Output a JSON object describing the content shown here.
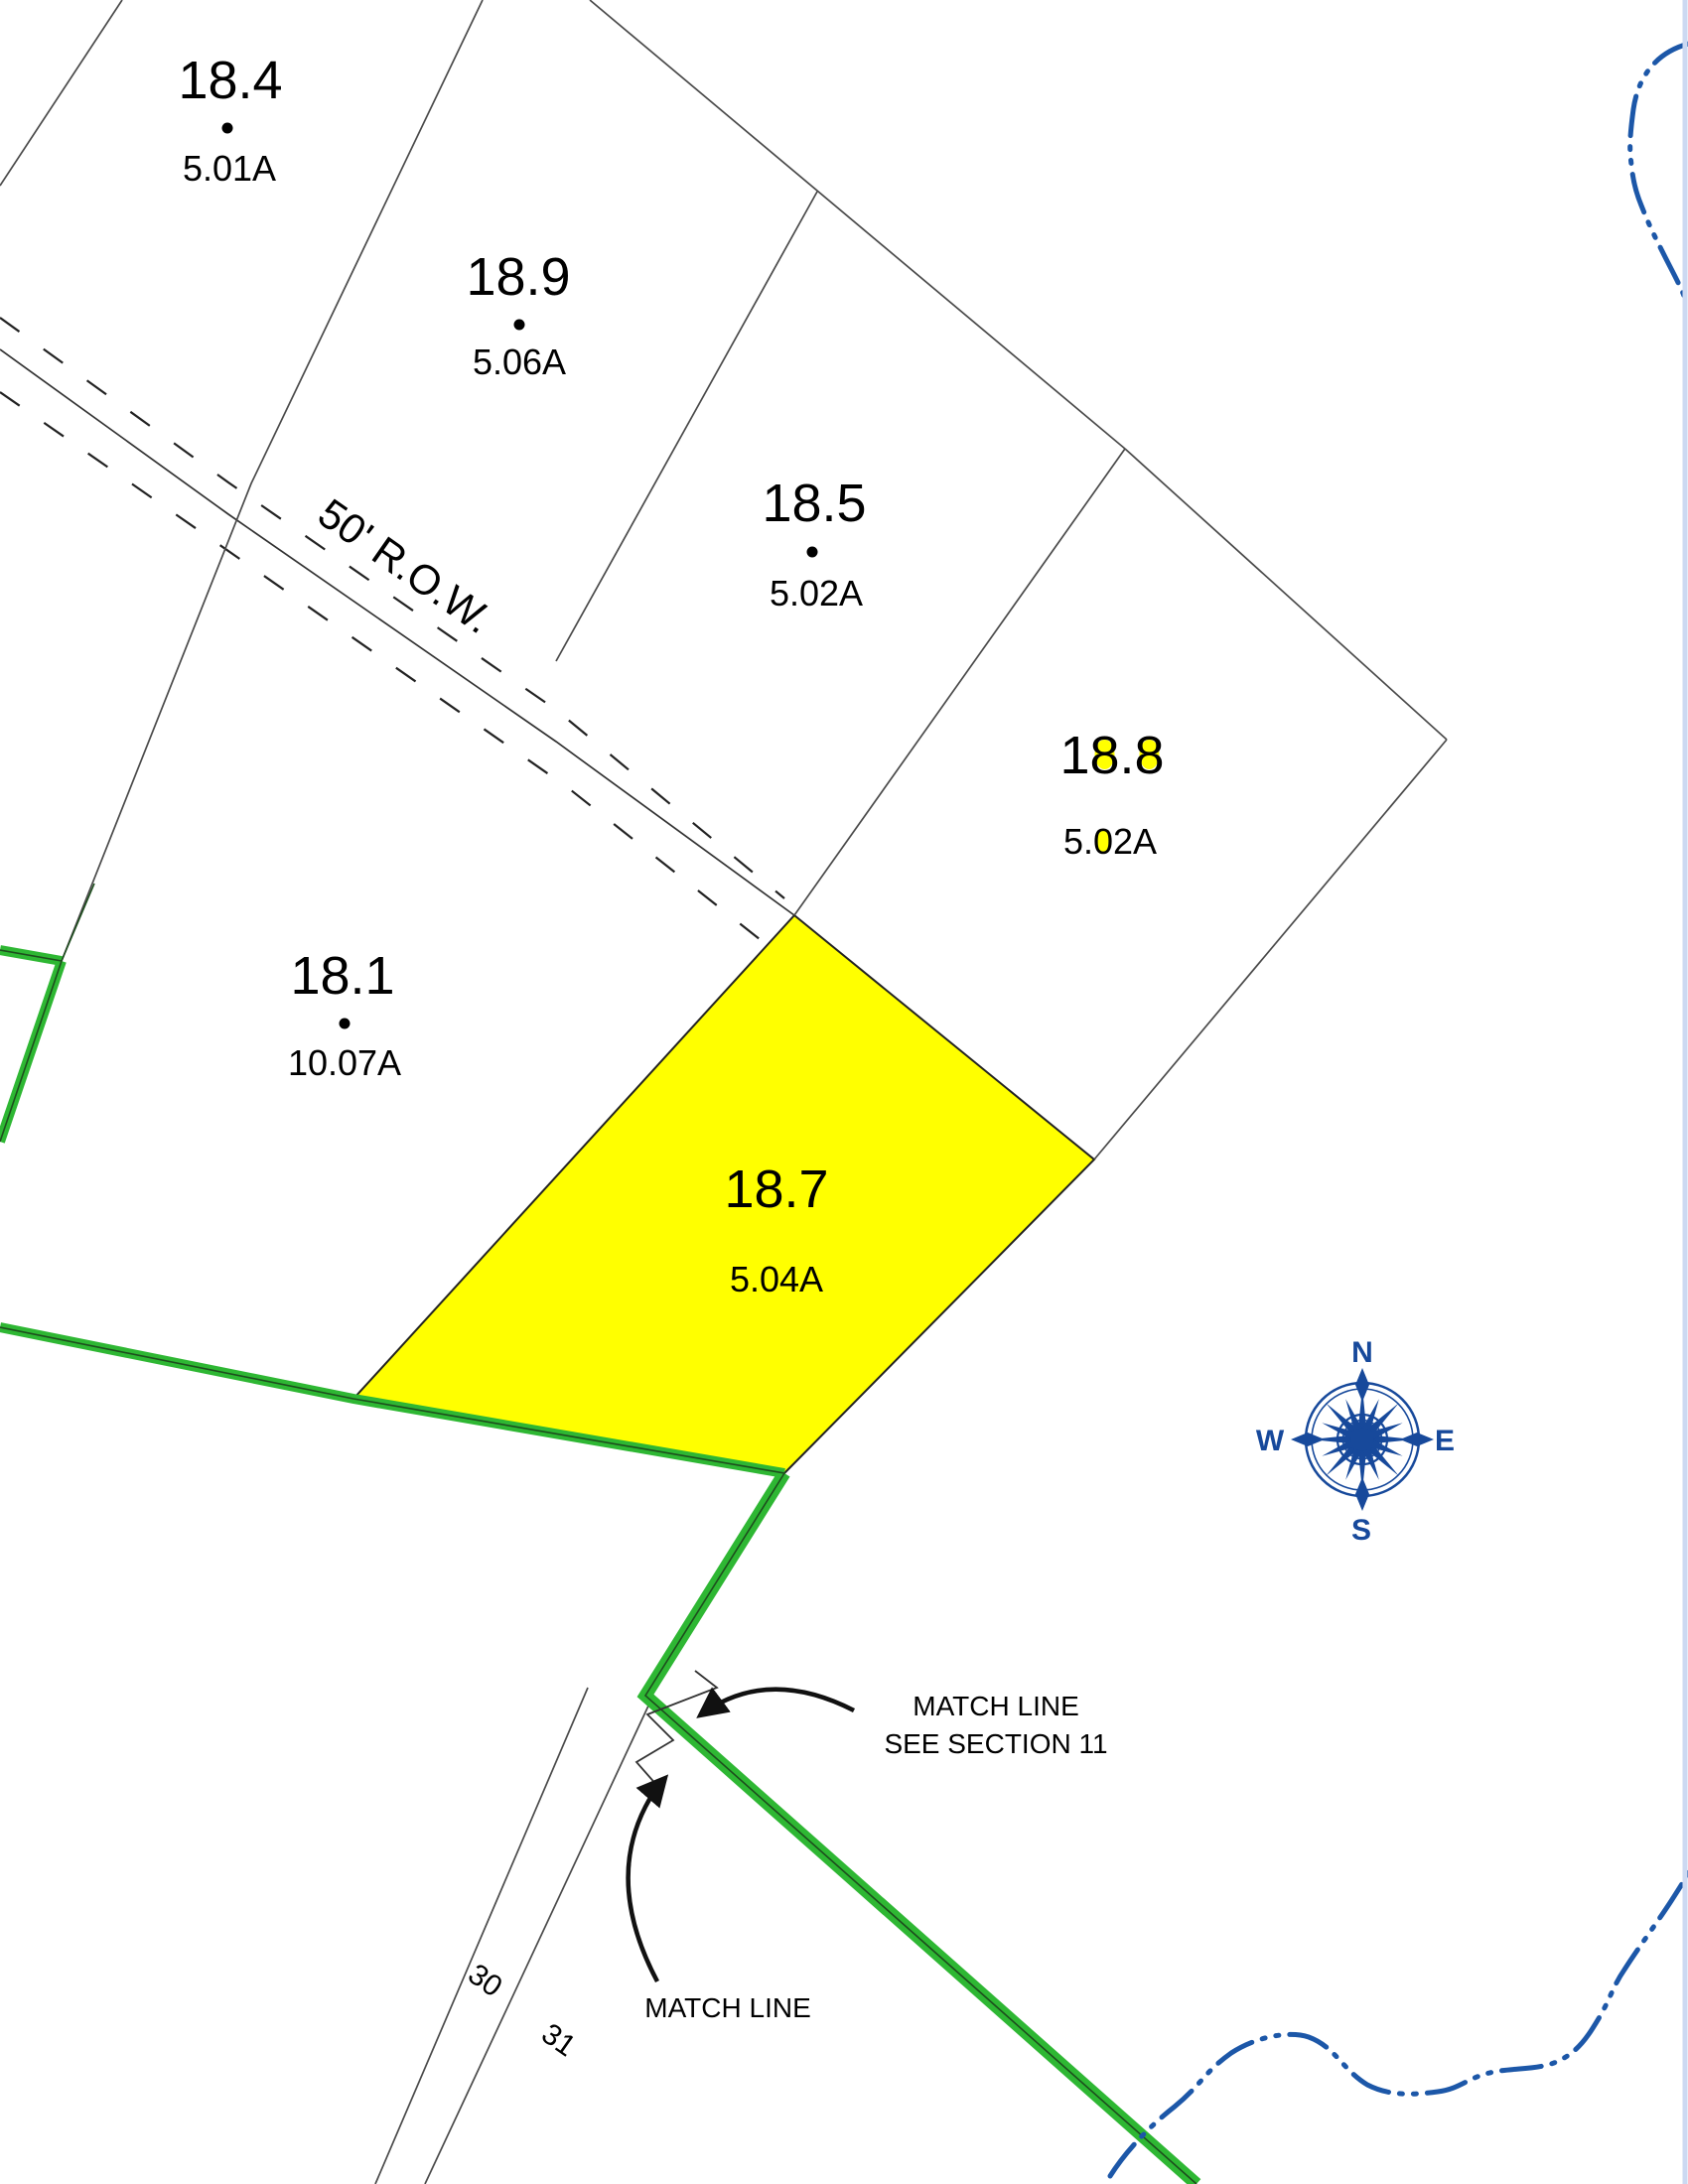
{
  "map_type": "tax-parcel-map section sheet",
  "parcels": [
    {
      "id": "18.4",
      "acreage": "5.01A",
      "center_dot": true,
      "highlighted": false
    },
    {
      "id": "18.9",
      "acreage": "5.06A",
      "center_dot": true,
      "highlighted": false
    },
    {
      "id": "18.5",
      "acreage": "5.02A",
      "center_dot": true,
      "highlighted": false
    },
    {
      "id": "18.8",
      "acreage": "5.02A",
      "center_dot": false,
      "highlighted": false
    },
    {
      "id": "18.1",
      "acreage": "10.07A",
      "center_dot": true,
      "highlighted": false
    },
    {
      "id": "18.7",
      "acreage": "5.04A",
      "center_dot": false,
      "highlighted": true
    }
  ],
  "road": {
    "label": "50' R.O.W."
  },
  "adjacent_lots": {
    "lot_30": "30",
    "lot_31": "31"
  },
  "annotations": {
    "match_line_callout_line1": "MATCH LINE",
    "match_line_callout_line2": "SEE SECTION 11",
    "match_line_label": "MATCH LINE"
  },
  "compass": {
    "north": "N",
    "south": "S",
    "east": "E",
    "west": "W"
  },
  "colors": {
    "parcel_highlight": "#FFFF00",
    "boundary_green": "#2EB733",
    "compass_blue": "#17499B",
    "water_blue": "#1C57A8",
    "neatline_blue": "#CCD9F2",
    "boundary_line": "#4A4A4A"
  }
}
